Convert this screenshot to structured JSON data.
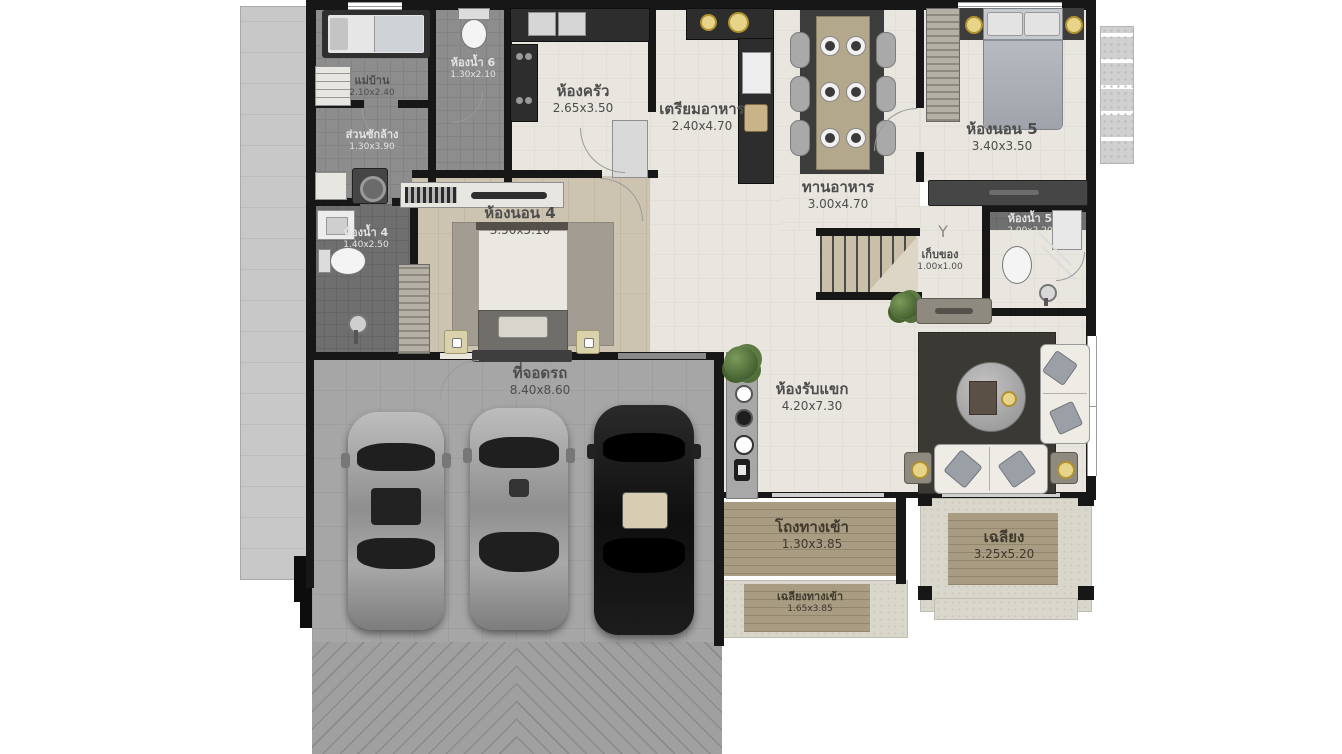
{
  "plan_title": "single-storey-house-floor-plan",
  "rooms": [
    {
      "name": "แม่บ้าน",
      "dims": "2.10x2.40"
    },
    {
      "name": "ห้องน้ำ 6",
      "dims": "1.30x2.10"
    },
    {
      "name": "ห้องครัว",
      "dims": "2.65x3.50"
    },
    {
      "name": "เตรียมอาหาร",
      "dims": "2.40x4.70"
    },
    {
      "name": "ทานอาหาร",
      "dims": "3.00x4.70"
    },
    {
      "name": "ห้องนอน 5",
      "dims": "3.40x3.50"
    },
    {
      "name": "ส่วนซักล้าง",
      "dims": "1.30x3.90"
    },
    {
      "name": "ห้องน้ำ 4",
      "dims": "1.40x2.50"
    },
    {
      "name": "ห้องนอน 4",
      "dims": "3.50x5.10"
    },
    {
      "name": "ห้องน้ำ 5",
      "dims": "2.00x2.20"
    },
    {
      "name": "เก็บของ",
      "dims": "1.00x1.00"
    },
    {
      "name": "ที่จอดรถ",
      "dims": "8.40x8.60"
    },
    {
      "name": "ห้องรับแขก",
      "dims": "4.20x7.30"
    },
    {
      "name": "โถงทางเข้า",
      "dims": "1.30x3.85"
    },
    {
      "name": "เฉลียง",
      "dims": "3.25x5.20"
    },
    {
      "name": "เฉลียงทางเข้า",
      "dims": "1.65x3.85"
    }
  ],
  "cars": [
    {
      "color_name": "silver",
      "hex": "#9c9c9c"
    },
    {
      "color_name": "silver",
      "hex": "#a3a3a3"
    },
    {
      "color_name": "black",
      "hex": "#141414"
    }
  ],
  "palette": {
    "wall": "#171717",
    "floor_light": "#e9e6df",
    "tile_gray": "#8d8d8d",
    "tile_dark": "#6f6f6f",
    "bedroom_wood": "#cdc3b1",
    "terrace_wood": "#a89c83",
    "concrete": "#d9d6cb",
    "parking": "#a6a6a6",
    "label_text": "#4d4d4d"
  }
}
